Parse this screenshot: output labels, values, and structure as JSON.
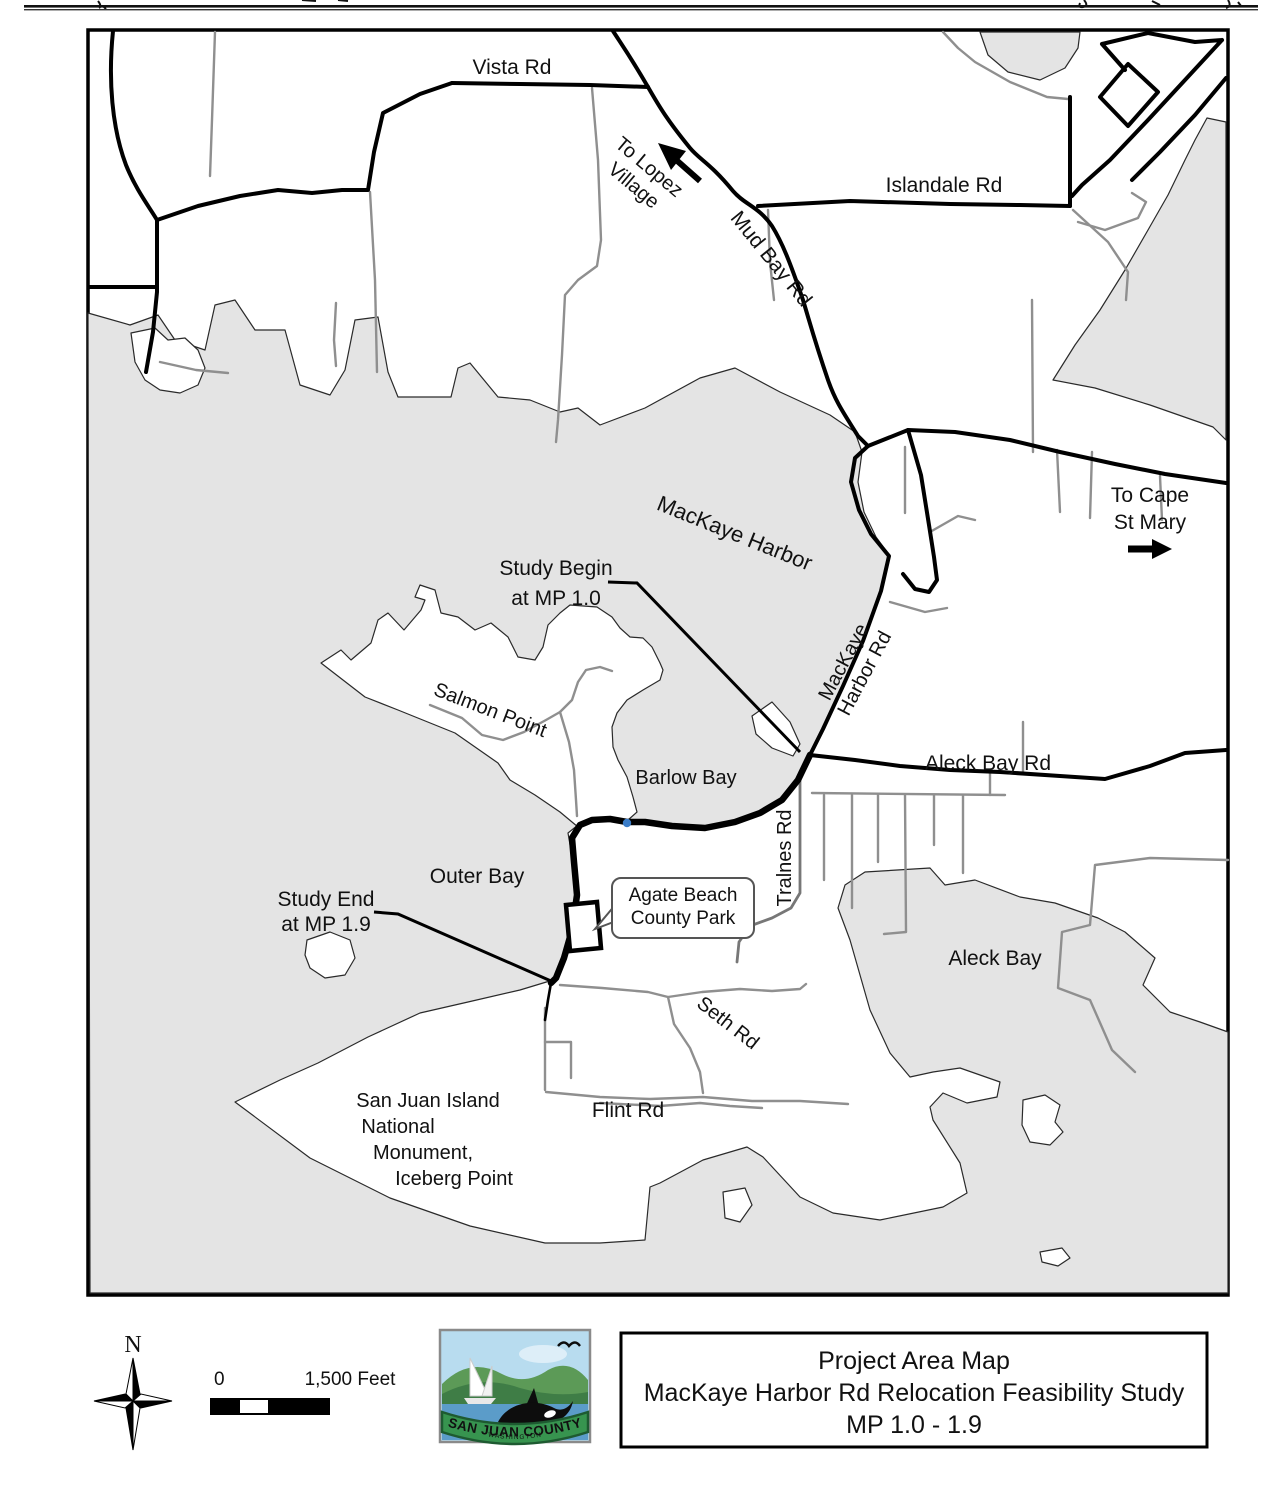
{
  "map": {
    "labels": [
      {
        "id": "vista-rd",
        "lines": [
          "Vista Rd"
        ],
        "x": 512,
        "y": 74,
        "rot": 0,
        "size": 21
      },
      {
        "id": "islandale-rd",
        "lines": [
          "Islandale Rd"
        ],
        "x": 944,
        "y": 192,
        "rot": 0,
        "size": 21
      },
      {
        "id": "mud-bay-rd",
        "lines": [
          "Mud Bay Rd"
        ],
        "x": 766,
        "y": 263,
        "rot": 51,
        "size": 21
      },
      {
        "id": "to-lopez-village",
        "lines": [
          "To Lopez",
          "Village"
        ],
        "x": 645,
        "y": 172,
        "rot": 40,
        "size": 20,
        "lh": 24
      },
      {
        "id": "to-cape-st-mary",
        "lines": [
          "To Cape",
          "St Mary"
        ],
        "x": 1150,
        "y": 502,
        "rot": 0,
        "size": 21,
        "lh": 27
      },
      {
        "id": "mackaye-harbor",
        "lines": [
          "MacKaye Harbor"
        ],
        "x": 732,
        "y": 540,
        "rot": 22,
        "size": 22
      },
      {
        "id": "study-begin",
        "lines": [
          "Study Begin",
          "at MP 1.0"
        ],
        "x": 556,
        "y": 575,
        "rot": 0,
        "size": 21,
        "lh": 30
      },
      {
        "id": "salmon-point",
        "lines": [
          "Salmon Point"
        ],
        "x": 488,
        "y": 716,
        "rot": 21,
        "size": 20
      },
      {
        "id": "barlow-bay",
        "lines": [
          "Barlow Bay"
        ],
        "x": 686,
        "y": 784,
        "rot": 0,
        "size": 20
      },
      {
        "id": "mackaye-harbor-rd",
        "lines": [
          "MacKaye",
          "Harbor Rd"
        ],
        "x": 849,
        "y": 665,
        "rot": -62,
        "size": 20,
        "lh": 24
      },
      {
        "id": "aleck-bay-rd",
        "lines": [
          "Aleck Bay Rd"
        ],
        "x": 988,
        "y": 770,
        "rot": 0,
        "size": 21
      },
      {
        "id": "tralnes-rd",
        "lines": [
          "Tralnes Rd"
        ],
        "x": 791,
        "y": 858,
        "rot": -90,
        "size": 20
      },
      {
        "id": "outer-bay",
        "lines": [
          "Outer Bay"
        ],
        "x": 477,
        "y": 883,
        "rot": 0,
        "size": 21
      },
      {
        "id": "study-end",
        "lines": [
          "Study End",
          "at MP 1.9"
        ],
        "x": 326,
        "y": 906,
        "rot": 0,
        "size": 21,
        "lh": 25
      },
      {
        "id": "aleck-bay",
        "lines": [
          "Aleck Bay"
        ],
        "x": 995,
        "y": 965,
        "rot": 0,
        "size": 21
      },
      {
        "id": "seth-rd",
        "lines": [
          "Seth Rd"
        ],
        "x": 724,
        "y": 1028,
        "rot": 38,
        "size": 20
      },
      {
        "id": "flint-rd",
        "lines": [
          "Flint Rd"
        ],
        "x": 628,
        "y": 1117,
        "rot": 0,
        "size": 21
      },
      {
        "id": "sji-monument",
        "lines": [
          "San Juan Island",
          "National",
          "Monument,",
          "Iceberg Point"
        ],
        "x": 428,
        "y": 1107,
        "rot": 0,
        "size": 20,
        "lh": 26,
        "dx": [
          0,
          -30,
          -5,
          26
        ]
      }
    ],
    "callout": {
      "lines": [
        "Agate Beach",
        "County Park"
      ]
    },
    "annotations": {
      "study_begin": "Study Begin at MP 1.0",
      "study_end": "Study End at MP 1.9"
    }
  },
  "legend": {
    "north_label": "N",
    "scale": {
      "zero": "0",
      "distance": "1,500 Feet"
    },
    "logo": {
      "name": "San Juan County logo",
      "banner": "SAN JUAN COUNTY",
      "subtitle": "WASHINGTON"
    },
    "title_box": {
      "lines": [
        "Project Area Map",
        "MacKaye Harbor Rd Relocation Feasibility Study",
        "MP 1.0 - 1.9"
      ]
    }
  },
  "colors": {
    "water": "#e4e4e4",
    "coastline": "#2a2a2a",
    "road_major": "#000000",
    "road_minor": "#8f8f8f",
    "marker_blue": "#3b7dc8",
    "banner_green": "#37944f"
  }
}
